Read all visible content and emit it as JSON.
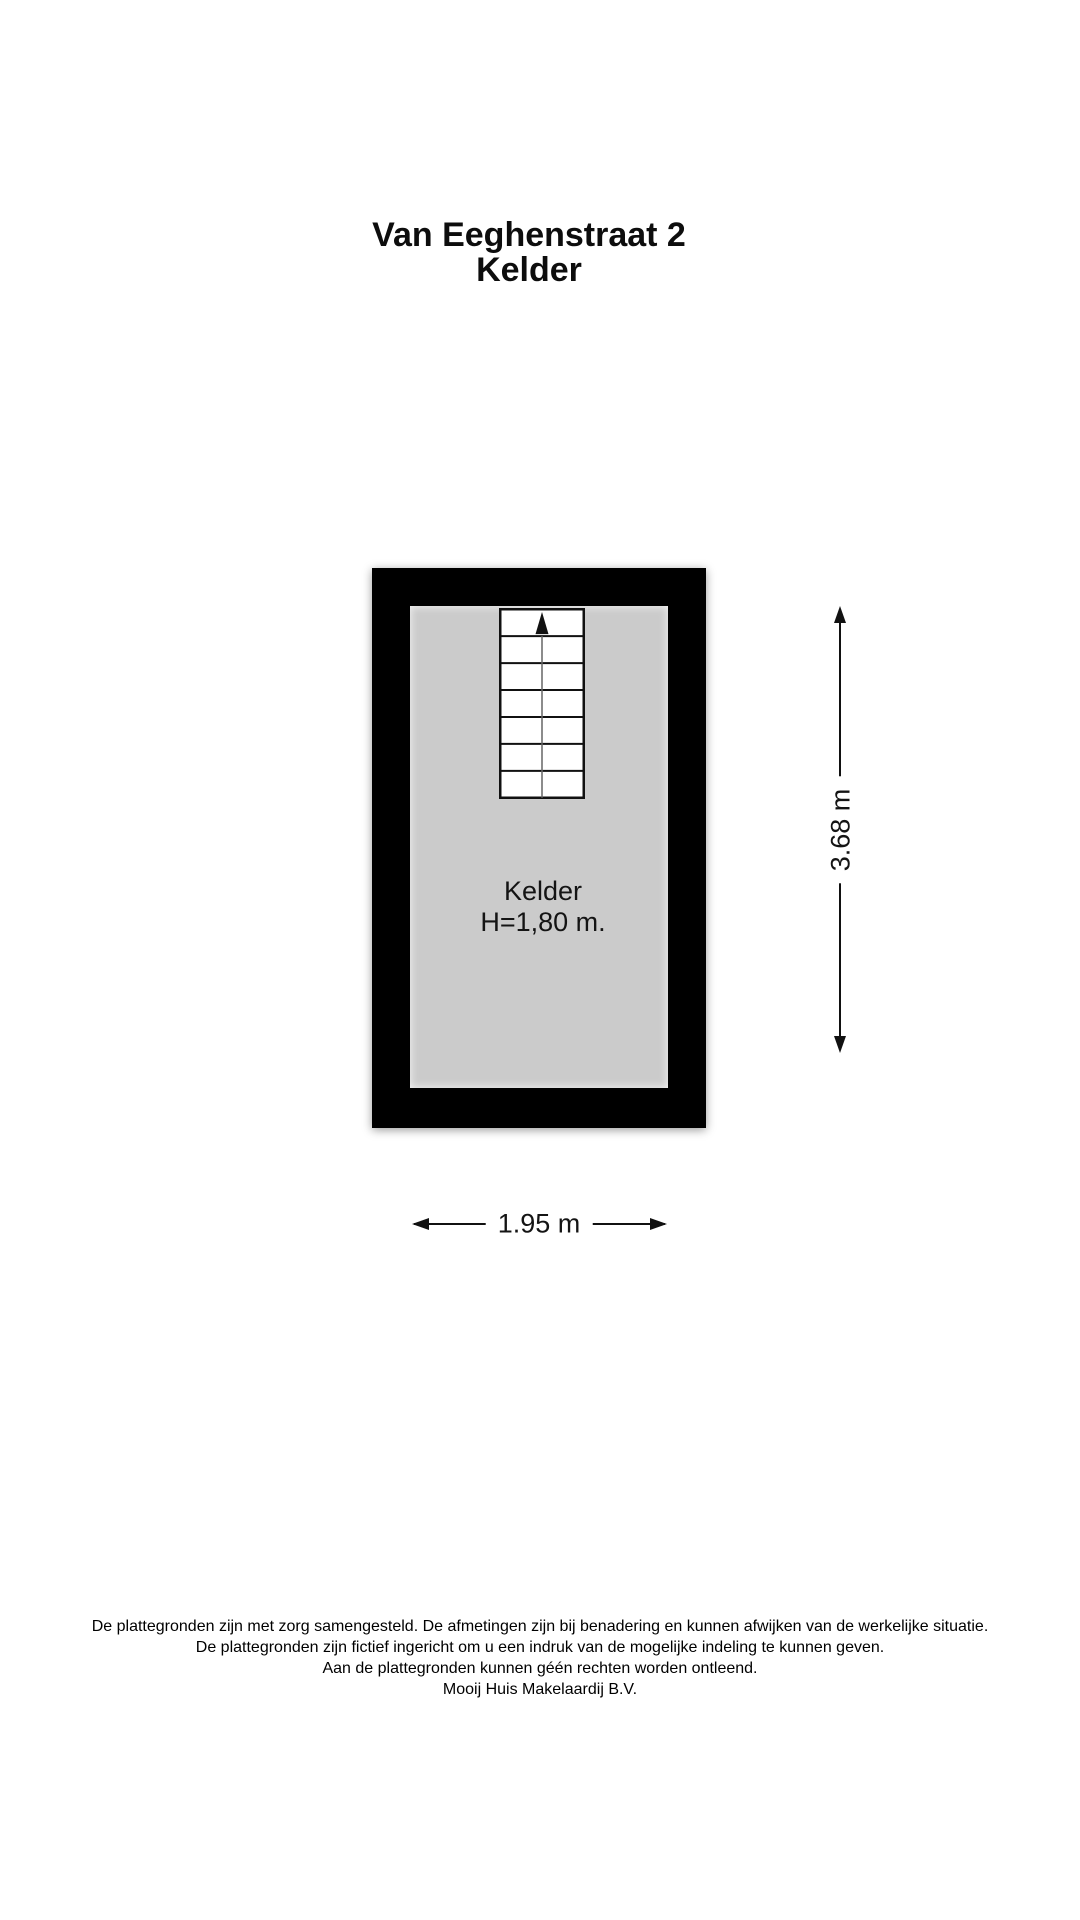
{
  "title": {
    "line1": "Van Eeghenstraat 2",
    "line2": "Kelder"
  },
  "floorplan": {
    "room_label": "Kelder",
    "ceiling_height_label": "H=1,80 m.",
    "stairs": {
      "tread_count": 7,
      "direction_arrow": "up"
    },
    "colors": {
      "wall": "#000000",
      "floor": "#cbcbcb",
      "stair_fill": "#ffffff",
      "outline": "#111111"
    }
  },
  "dimensions": {
    "height_label": "3.68 m",
    "width_label": "1.95 m"
  },
  "footer": {
    "lines": [
      "De plattegronden zijn met zorg samengesteld. De afmetingen zijn bij benadering en kunnen afwijken van de werkelijke situatie.",
      "De plattegronden zijn fictief ingericht om u een indruk van de mogelijke indeling te kunnen geven.",
      "Aan de plattegronden kunnen géén rechten worden ontleend.",
      "Mooij Huis Makelaardij B.V."
    ]
  }
}
